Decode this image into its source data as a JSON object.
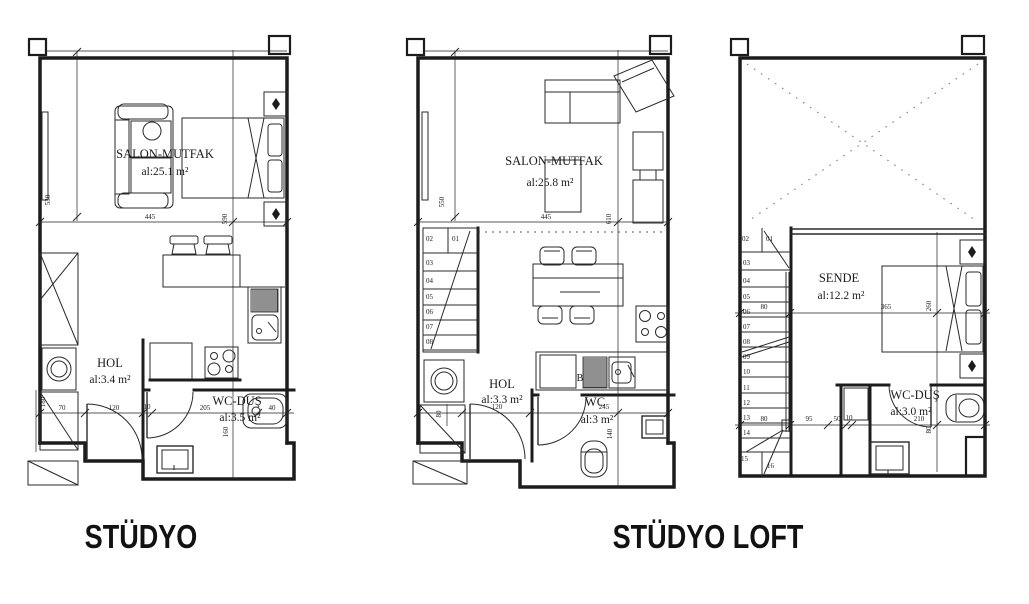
{
  "titles": {
    "studyo": "STÜDYO",
    "studyo_loft": "STÜDYO LOFT"
  },
  "plans": {
    "p1": {
      "rooms": {
        "salon": {
          "name": "SALON-MUTFAK",
          "area": "al:25.1 m²"
        },
        "hol": {
          "name": "HOL",
          "area": "al:3.4 m²"
        },
        "wc": {
          "name": "WC-DUŞ",
          "area": "al:3.5 m²"
        }
      },
      "dims": {
        "h_salon": "530",
        "w_salon": "445",
        "h_right": "590",
        "h_shaft": "180",
        "b1": "70",
        "b2": "120",
        "b3": "10",
        "b4": "205",
        "b5": "40",
        "h_wc": "160"
      }
    },
    "p2": {
      "rooms": {
        "salon": {
          "name": "SALON-MUTFAK",
          "area": "al:25.8 m²"
        },
        "hol": {
          "name": "HOL",
          "area": "al:3.3 m²"
        },
        "wc": {
          "name": "WC",
          "area": "al:3 m²"
        }
      },
      "dims": {
        "h_salon": "550",
        "w_salon": "445",
        "h_right": "610",
        "w_washer": "80",
        "b1": "120",
        "b2": "245",
        "h_wc": "140"
      },
      "appliance_label": "B",
      "stairs": [
        "01",
        "02",
        "03",
        "04",
        "05",
        "06",
        "07",
        "08"
      ]
    },
    "p3": {
      "rooms": {
        "sende": {
          "name": "SENDE",
          "area": "al:12.2 m²"
        },
        "wc": {
          "name": "WC-DUŞ",
          "area": "al:3.0 m²"
        }
      },
      "dims": {
        "w_stair_mid": "80",
        "w_bed": "365",
        "h_bed": "260",
        "w_stair_low": "80",
        "b1": "95",
        "b2": "50",
        "b3": "10",
        "b4": "210",
        "h_wc": "80"
      },
      "stairs": [
        "01",
        "02",
        "03",
        "04",
        "05",
        "06",
        "07",
        "08",
        "09",
        "10",
        "11",
        "12",
        "13",
        "14",
        "15",
        "16"
      ]
    }
  }
}
